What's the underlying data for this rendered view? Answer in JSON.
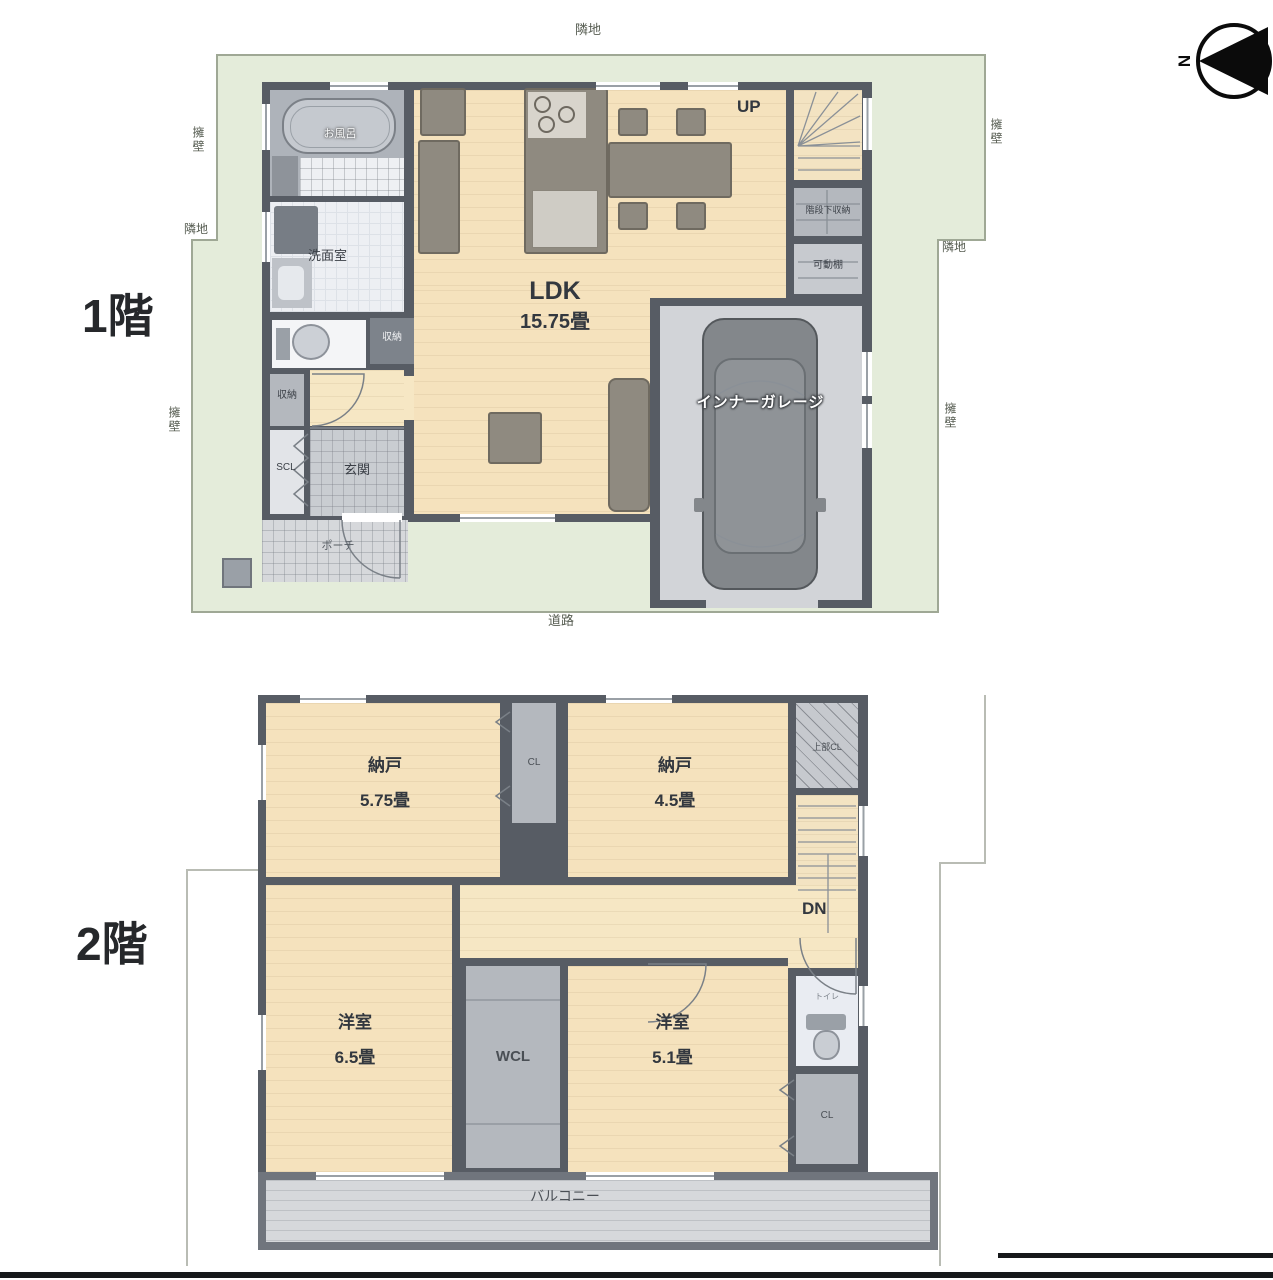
{
  "compass": {
    "n": "N"
  },
  "colors": {
    "wall": "#575c64",
    "site_green": "#e4ecda",
    "wood_floor": "#f5e2bd",
    "closet_gray": "#b4b8be",
    "garage_floor": "#d2d4d8"
  },
  "floor1": {
    "label": "1階",
    "site": {
      "top": "隣地",
      "bottom": "道路",
      "left_upper": "擁壁",
      "left_mid": "隣地",
      "left_lower": "擁壁",
      "right_upper": "擁壁",
      "right_mid": "隣地",
      "right_lower": "擁壁"
    },
    "rooms": {
      "bath": "お風呂",
      "washroom": "洗面室",
      "closet_hall": "収納",
      "closet_left": "収納",
      "scl": "SCL",
      "genkan": "玄関",
      "porch": "ポーチ",
      "ldk_name": "LDK",
      "ldk_size": "15.75畳",
      "up": "UP",
      "under_stairs": "階段下収納",
      "movable_shelf": "可動棚",
      "garage": "インナーガレージ"
    }
  },
  "floor2": {
    "label": "2階",
    "rooms": {
      "nando1": "納戸",
      "nando1_size": "5.75畳",
      "cl1": "CL",
      "nando2": "納戸",
      "nando2_size": "4.5畳",
      "upper_cl": "上部CL",
      "dn": "DN",
      "youshitsu1": "洋室",
      "youshitsu1_size": "6.5畳",
      "wcl": "WCL",
      "youshitsu2": "洋室",
      "youshitsu2_size": "5.1畳",
      "toilet": "トイレ",
      "cl2": "CL",
      "balcony": "バルコニー"
    }
  }
}
